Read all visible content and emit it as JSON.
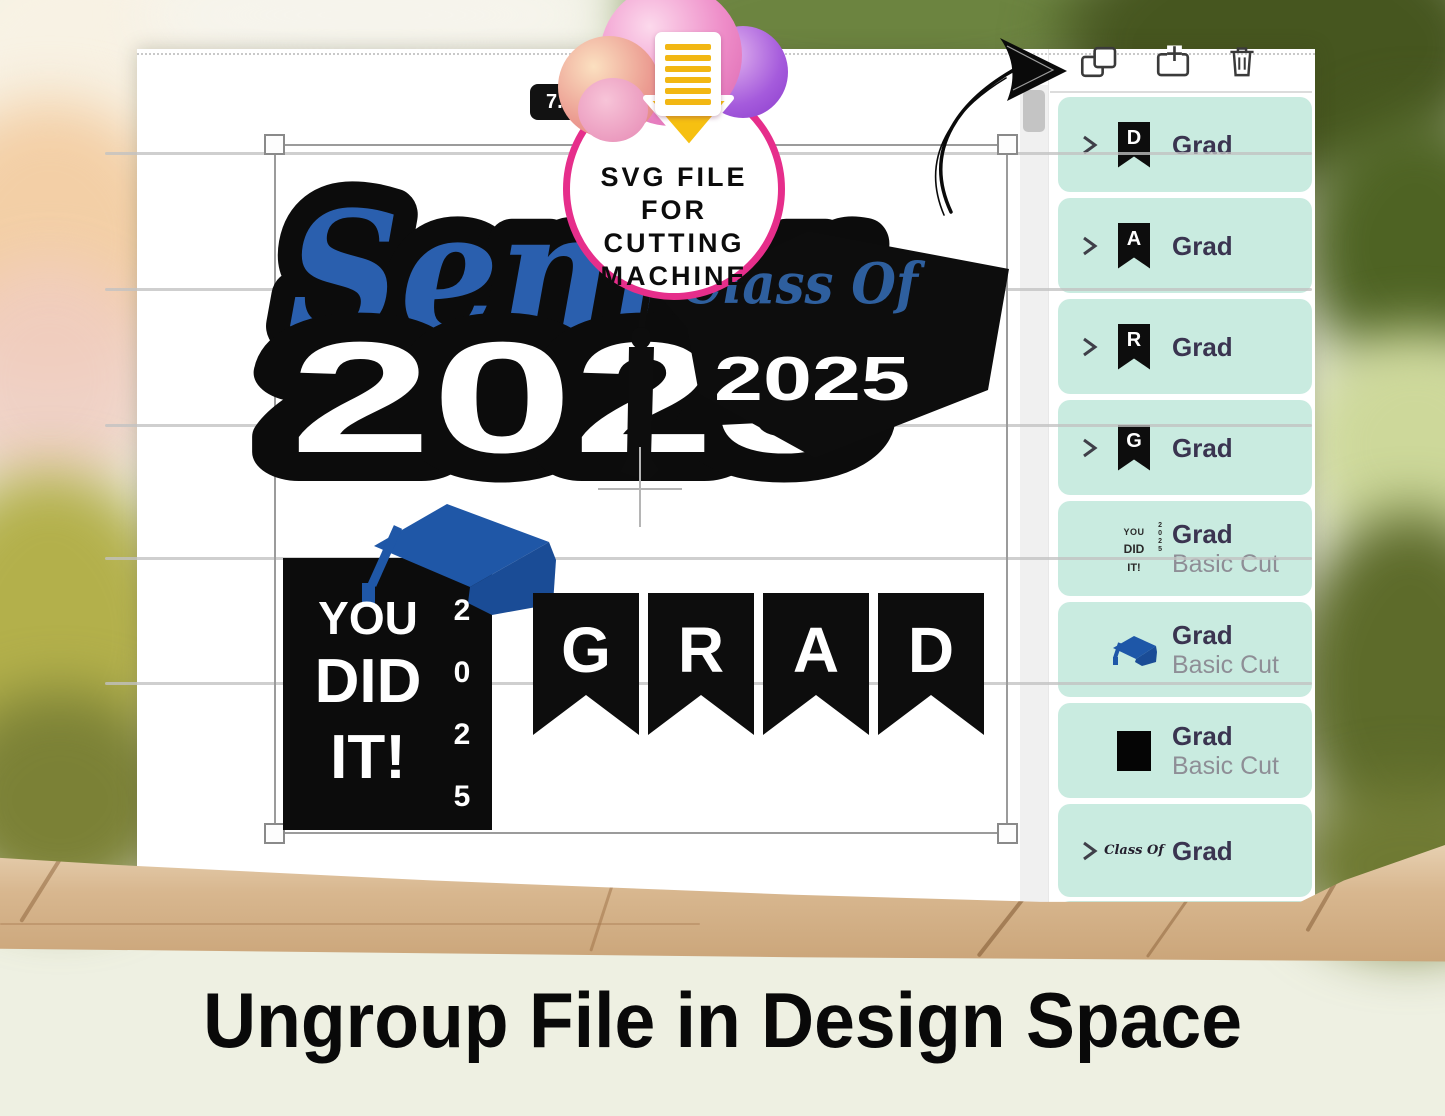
{
  "badge": {
    "line1": "SVG FILE",
    "line2": "FOR CUTTING",
    "line3": "MACHINE"
  },
  "tooltip": {
    "text": "7."
  },
  "caption": "Ungroup File in Design Space",
  "toolbar": {
    "icons": [
      "ungroup",
      "add-template",
      "delete"
    ]
  },
  "panel": {
    "items": [
      {
        "label": "Grad",
        "icon": "pennant-banner",
        "letter": "D",
        "chevron": true
      },
      {
        "label": "Grad",
        "icon": "pennant-banner",
        "letter": "A",
        "chevron": true
      },
      {
        "label": "Grad",
        "icon": "pennant-banner",
        "letter": "R",
        "chevron": true
      },
      {
        "label": "Grad",
        "icon": "pennant-banner",
        "letter": "G",
        "chevron": true
      },
      {
        "label": "Grad",
        "sublabel": "Basic Cut",
        "icon": "you-did-it-thumb"
      },
      {
        "label": "Grad",
        "sublabel": "Basic Cut",
        "icon": "blue-grad-cap"
      },
      {
        "label": "Grad",
        "sublabel": "Basic Cut",
        "icon": "black-square"
      },
      {
        "label": "Grad",
        "icon": "class-of-script",
        "chevron": true
      }
    ]
  },
  "canvas": {
    "senior": {
      "script": "Senior",
      "year": "2025"
    },
    "cap": {
      "script": "Class Of",
      "year": "2025"
    },
    "youdidit": {
      "line1": "YOU",
      "line2": "DID",
      "line3": "IT!",
      "digits": [
        "2",
        "0",
        "2",
        "5"
      ]
    },
    "banner": {
      "letters": [
        "G",
        "R",
        "A",
        "D"
      ]
    }
  },
  "colors": {
    "mint_item": "#c9ebe0",
    "badge_ring_pink": "#e62e8b",
    "design_blue": "#2a5fae",
    "design_black": "#0d0d0d",
    "label_dark": "#3a3450",
    "sublabel_gray": "#8e8e96"
  }
}
